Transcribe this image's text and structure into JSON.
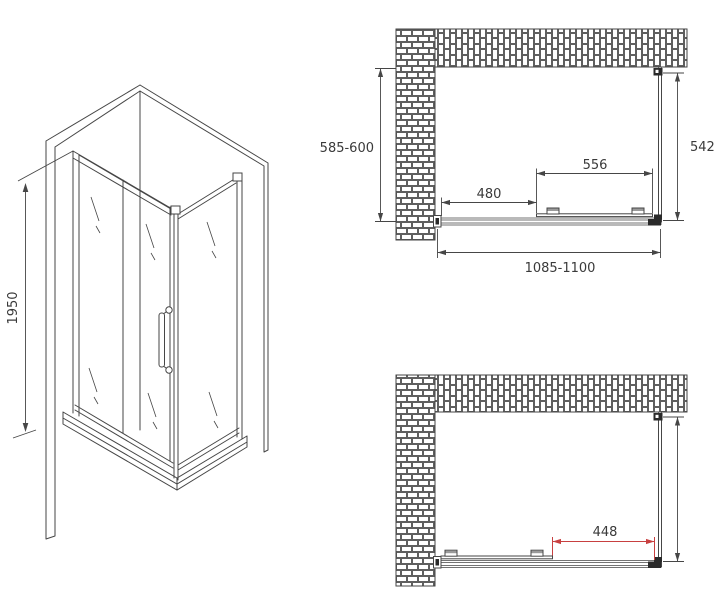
{
  "views": {
    "isometric": {
      "height": "1950"
    },
    "plan_closed": {
      "depth": "585-600",
      "side_panel": "542",
      "door_width": "556",
      "fixed_panel_width": "480",
      "overall_width": "1085-1100"
    },
    "plan_open": {
      "opening_width": "448"
    }
  },
  "colors": {
    "line": "#464646",
    "text": "#3a3a3a",
    "dimension_red": "#c84040"
  }
}
